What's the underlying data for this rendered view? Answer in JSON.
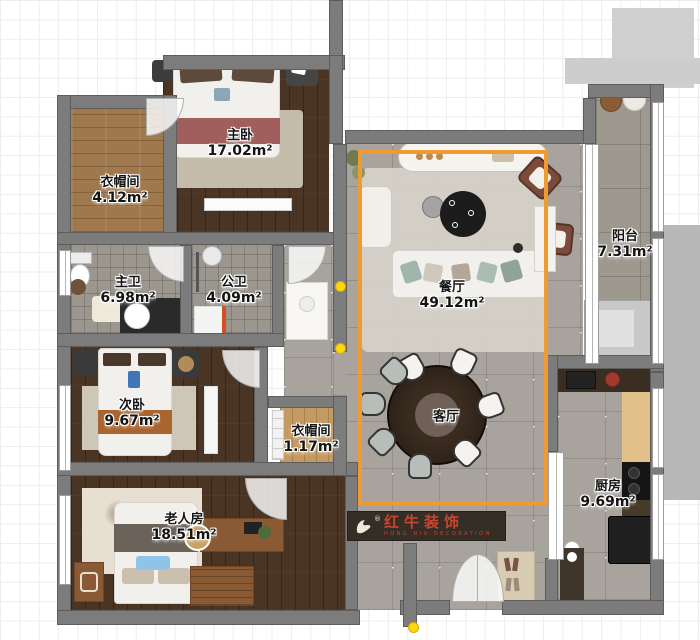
{
  "rooms": [
    {
      "id": "closet-main",
      "name": "衣帽间",
      "area": "4.12m²"
    },
    {
      "id": "master-bedroom",
      "name": "主卧",
      "area": "17.02m²"
    },
    {
      "id": "master-bath",
      "name": "主卫",
      "area": "6.98m²"
    },
    {
      "id": "public-bath",
      "name": "公卫",
      "area": "4.09m²"
    },
    {
      "id": "second-bedroom",
      "name": "次卧",
      "area": "9.67m²"
    },
    {
      "id": "closet-small",
      "name": "衣帽间",
      "area": "1.17m²"
    },
    {
      "id": "elder-room",
      "name": "老人房",
      "area": "18.51m²"
    },
    {
      "id": "dining-room",
      "name": "餐厅",
      "area": "49.12m²"
    },
    {
      "id": "living-room",
      "name": "客厅",
      "area": ""
    },
    {
      "id": "balcony",
      "name": "阳台",
      "area": "7.31m²"
    },
    {
      "id": "kitchen",
      "name": "厨房",
      "area": "9.69m²"
    }
  ],
  "logo": {
    "brand": "红牛装饰",
    "sub": "HONG NIU DECORATION",
    "registered": "®"
  },
  "colors": {
    "selection_accent": "#F09A32",
    "marker_yellow": "#FFD60A",
    "logo_red": "#C9452E",
    "logo_background": "#352E27",
    "wall_gray": "#7C7C7C"
  }
}
